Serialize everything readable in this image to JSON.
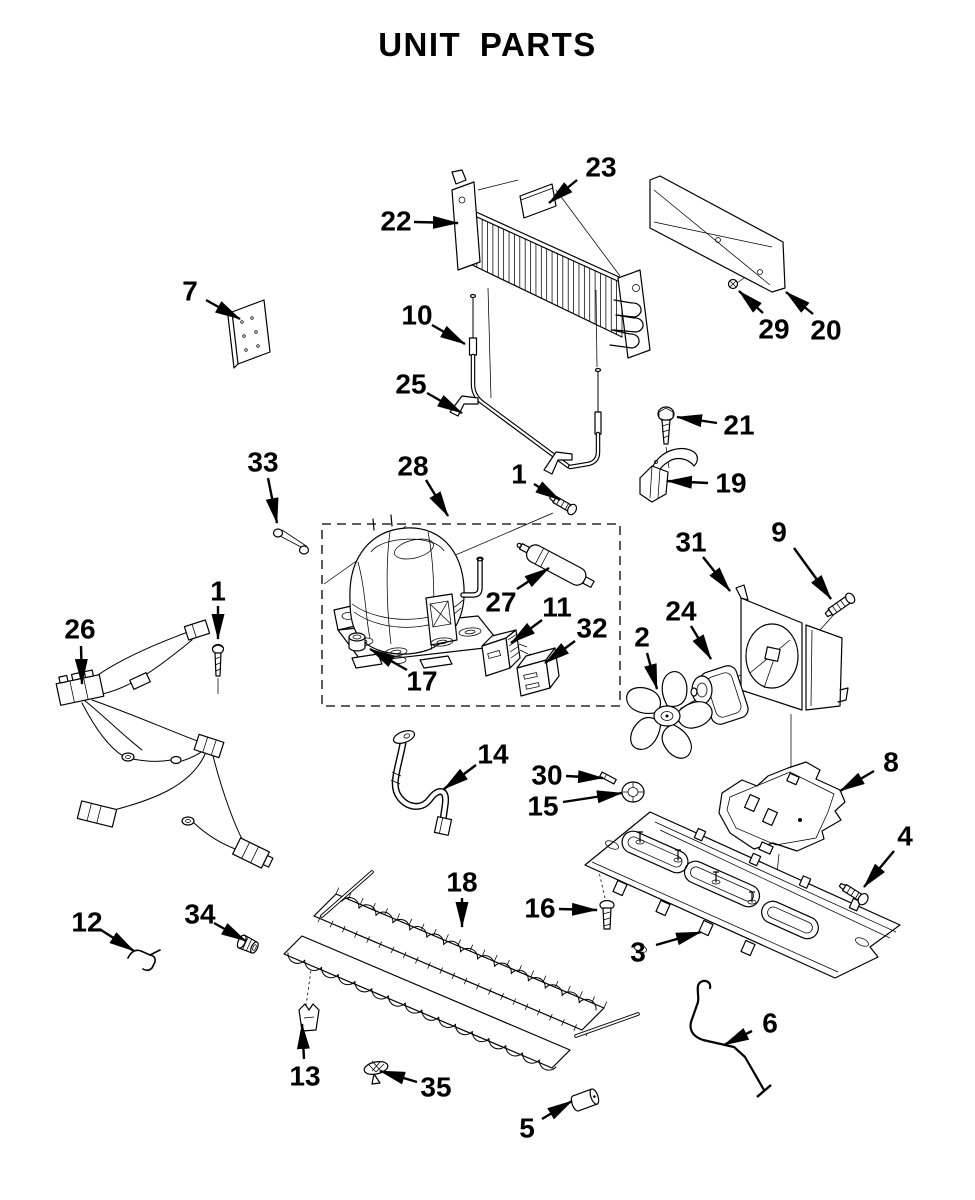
{
  "title": "UNIT PARTS",
  "colors": {
    "background": "#ffffff",
    "line": "#000000",
    "text": "#000000"
  },
  "callouts": [
    {
      "n": "23",
      "label": [
        601,
        167
      ],
      "arrow": [
        577,
        180,
        549,
        203
      ]
    },
    {
      "n": "22",
      "label": [
        396,
        221
      ],
      "arrow": [
        414,
        222,
        458,
        223
      ]
    },
    {
      "n": "29",
      "label": [
        774,
        329
      ],
      "arrow": [
        763,
        313,
        739,
        291
      ]
    },
    {
      "n": "20",
      "label": [
        826,
        330
      ],
      "arrow": [
        813,
        314,
        786,
        292
      ]
    },
    {
      "n": "7",
      "label": [
        190,
        291
      ],
      "arrow": [
        206,
        300,
        240,
        319
      ]
    },
    {
      "n": "10",
      "label": [
        417,
        315
      ],
      "arrow": [
        432,
        325,
        465,
        344
      ]
    },
    {
      "n": "25",
      "label": [
        411,
        384
      ],
      "arrow": [
        427,
        393,
        462,
        413
      ]
    },
    {
      "n": "21",
      "label": [
        739,
        425
      ],
      "arrow": [
        717,
        423,
        677,
        417
      ]
    },
    {
      "n": "19",
      "label": [
        731,
        483
      ],
      "arrow": [
        708,
        483,
        667,
        481
      ]
    },
    {
      "n": "33",
      "label": [
        263,
        462
      ],
      "arrow": [
        268,
        478,
        277,
        523
      ]
    },
    {
      "n": "28",
      "label": [
        413,
        466
      ],
      "arrow": [
        426,
        480,
        448,
        516
      ]
    },
    {
      "n": "1",
      "label": [
        519,
        474
      ],
      "arrow": [
        534,
        484,
        560,
        500
      ]
    },
    {
      "n": "27",
      "label": [
        501,
        602
      ],
      "arrow": [
        517,
        589,
        549,
        568
      ]
    },
    {
      "n": "11",
      "label": [
        557,
        607
      ],
      "arrow": [
        542,
        620,
        511,
        643
      ]
    },
    {
      "n": "32",
      "label": [
        592,
        628
      ],
      "arrow": [
        575,
        641,
        545,
        663
      ]
    },
    {
      "n": "2",
      "label": [
        642,
        637
      ],
      "arrow": [
        647,
        653,
        657,
        689
      ]
    },
    {
      "n": "24",
      "label": [
        681,
        611
      ],
      "arrow": [
        691,
        626,
        711,
        659
      ]
    },
    {
      "n": "31",
      "label": [
        691,
        542
      ],
      "arrow": [
        703,
        557,
        730,
        591
      ]
    },
    {
      "n": "9",
      "label": [
        779,
        532
      ],
      "arrow": [
        794,
        548,
        831,
        599
      ]
    },
    {
      "n": "17",
      "label": [
        422,
        681
      ],
      "arrow": [
        407,
        670,
        370,
        649
      ]
    },
    {
      "n": "26",
      "label": [
        80,
        629
      ],
      "arrow": [
        81,
        646,
        82,
        684
      ]
    },
    {
      "n": "1",
      "label": [
        218,
        591
      ],
      "arrow": [
        218,
        606,
        218,
        639
      ]
    },
    {
      "n": "8",
      "label": [
        891,
        762
      ],
      "arrow": [
        874,
        771,
        840,
        791
      ]
    },
    {
      "n": "14",
      "label": [
        493,
        754
      ],
      "arrow": [
        476,
        765,
        444,
        789
      ]
    },
    {
      "n": "30",
      "label": [
        547,
        775
      ],
      "arrow": [
        566,
        776,
        603,
        778
      ]
    },
    {
      "n": "15",
      "label": [
        543,
        806
      ],
      "arrow": [
        563,
        802,
        622,
        793
      ]
    },
    {
      "n": "4",
      "label": [
        905,
        836
      ],
      "arrow": [
        894,
        851,
        864,
        887
      ]
    },
    {
      "n": "16",
      "label": [
        540,
        908
      ],
      "arrow": [
        559,
        909,
        597,
        910
      ]
    },
    {
      "n": "3",
      "label": [
        638,
        952
      ],
      "arrow": [
        656,
        945,
        701,
        932
      ]
    },
    {
      "n": "18",
      "label": [
        462,
        882
      ],
      "arrow": [
        462,
        898,
        462,
        927
      ]
    },
    {
      "n": "12",
      "label": [
        87,
        922
      ],
      "arrow": [
        101,
        930,
        134,
        951
      ]
    },
    {
      "n": "34",
      "label": [
        200,
        914
      ],
      "arrow": [
        214,
        923,
        246,
        941
      ]
    },
    {
      "n": "13",
      "label": [
        305,
        1076
      ],
      "arrow": [
        304,
        1059,
        302,
        1024
      ]
    },
    {
      "n": "35",
      "label": [
        436,
        1087
      ],
      "arrow": [
        417,
        1082,
        380,
        1071
      ]
    },
    {
      "n": "5",
      "label": [
        527,
        1128
      ],
      "arrow": [
        542,
        1119,
        572,
        1101
      ]
    },
    {
      "n": "6",
      "label": [
        770,
        1023
      ],
      "arrow": [
        752,
        1031,
        724,
        1045
      ]
    }
  ]
}
